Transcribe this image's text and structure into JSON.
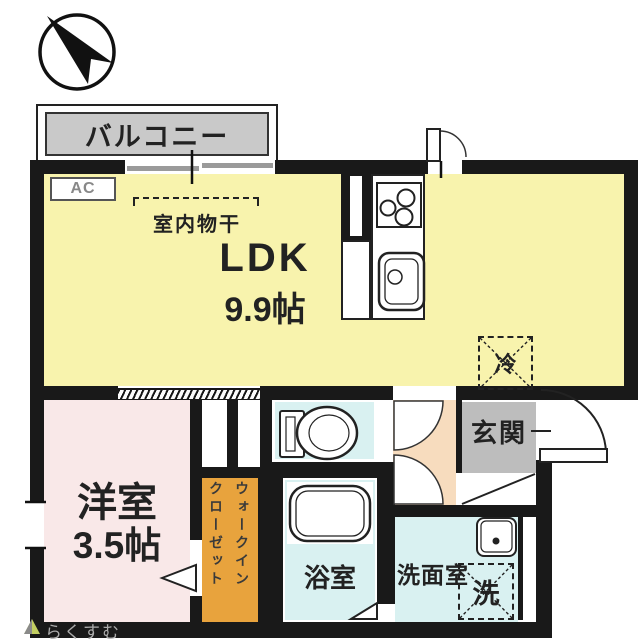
{
  "balcony": {
    "label": "バルコニー"
  },
  "ldk": {
    "name": "LDK",
    "size": "9.9帖",
    "ac_label": "AC",
    "drying_label": "室内物干",
    "fridge_label": "冷"
  },
  "western_room": {
    "name": "洋室",
    "size": "3.5帖"
  },
  "walk_in_closet": {
    "full_label": "ウォークインクローゼット",
    "line1": "ウォークイン",
    "line2": "クローゼット"
  },
  "bathroom": {
    "label": "浴室"
  },
  "washroom": {
    "label": "洗面室",
    "washer_label": "洗"
  },
  "entrance": {
    "label": "玄関"
  },
  "watermark": {
    "label": "らくすむ"
  },
  "colors": {
    "ldk": "#F8F3AD",
    "western_room": "#F9E8E8",
    "wet_rooms": "#D9F1F1",
    "hall": "#F7DCBE",
    "walk_in_closet": "#E8A33D",
    "entrance": "#BDBDBD",
    "balcony_label_bg": "#C9C9C9",
    "walls": "#191919"
  }
}
